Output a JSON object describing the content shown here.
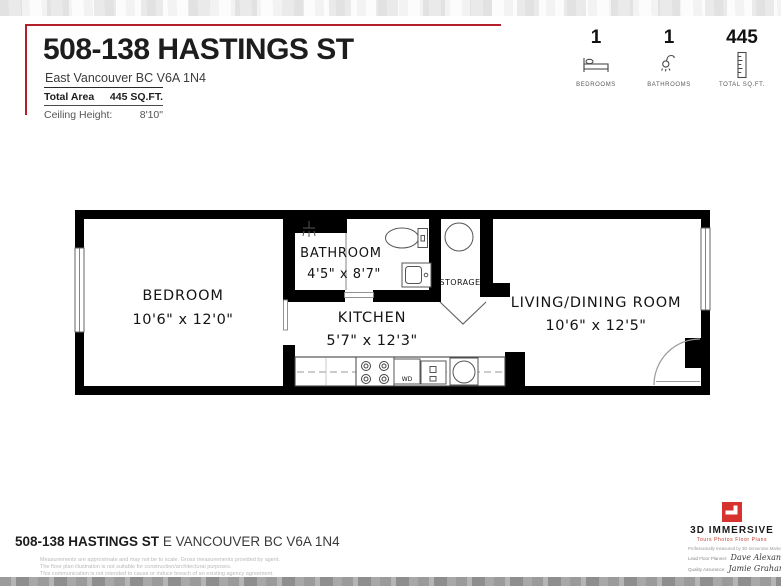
{
  "header": {
    "title": "508-138 HASTINGS ST",
    "subtitle": "East Vancouver BC V6A 1N4",
    "facts": [
      {
        "label": "Total Area",
        "value": "445 SQ.FT."
      },
      {
        "label": "Ceiling Height:",
        "value": "8'10\""
      }
    ],
    "stats": [
      {
        "value": "1",
        "label": "BEDROOMS",
        "icon": "bed-icon"
      },
      {
        "value": "1",
        "label": "BATHROOMS",
        "icon": "shower-icon"
      },
      {
        "value": "445",
        "label": "TOTAL SQ.FT.",
        "icon": "ruler-icon"
      }
    ]
  },
  "floorplan": {
    "rooms": [
      {
        "name": "BEDROOM",
        "dimensions": "10'6\" x 12'0\""
      },
      {
        "name": "BATHROOM",
        "dimensions": "4'5\" x 8'7\""
      },
      {
        "name": "KITCHEN",
        "dimensions": "5'7\" x 12'3\""
      },
      {
        "name": "STORAGE",
        "dimensions": ""
      },
      {
        "name": "LIVING/DINING ROOM",
        "dimensions": "10'6\" x 12'5\""
      }
    ],
    "labels": {
      "washer_dryer": "WD"
    }
  },
  "footer": {
    "address_bold": "508-138 HASTINGS ST",
    "address_rest": " E VANCOUVER BC V6A 1N4",
    "disclaimer_lines": [
      "Measurements are approximate and may not be to scale. Gross measurements provided by agent.",
      "The floor plan illustration is not suitable for construction/architectural purposes.",
      "This communication is not intended to cause or induce breach of an existing agency agreement."
    ],
    "logo": {
      "name": "3D IMMERSIVE",
      "tagline": "Tours   Photos   Floor Plans",
      "measured_by": "Professionally measured by 3D Immersive Marketing Ltd.",
      "lead_label": "Lead Floor Planner:",
      "lead_name": "Dave Alexander",
      "qa_label": "Quality Assurance:",
      "qa_name": "Jamie Graham"
    }
  },
  "colors": {
    "accent_red": "#b3202a",
    "logo_red": "#d6332f"
  }
}
